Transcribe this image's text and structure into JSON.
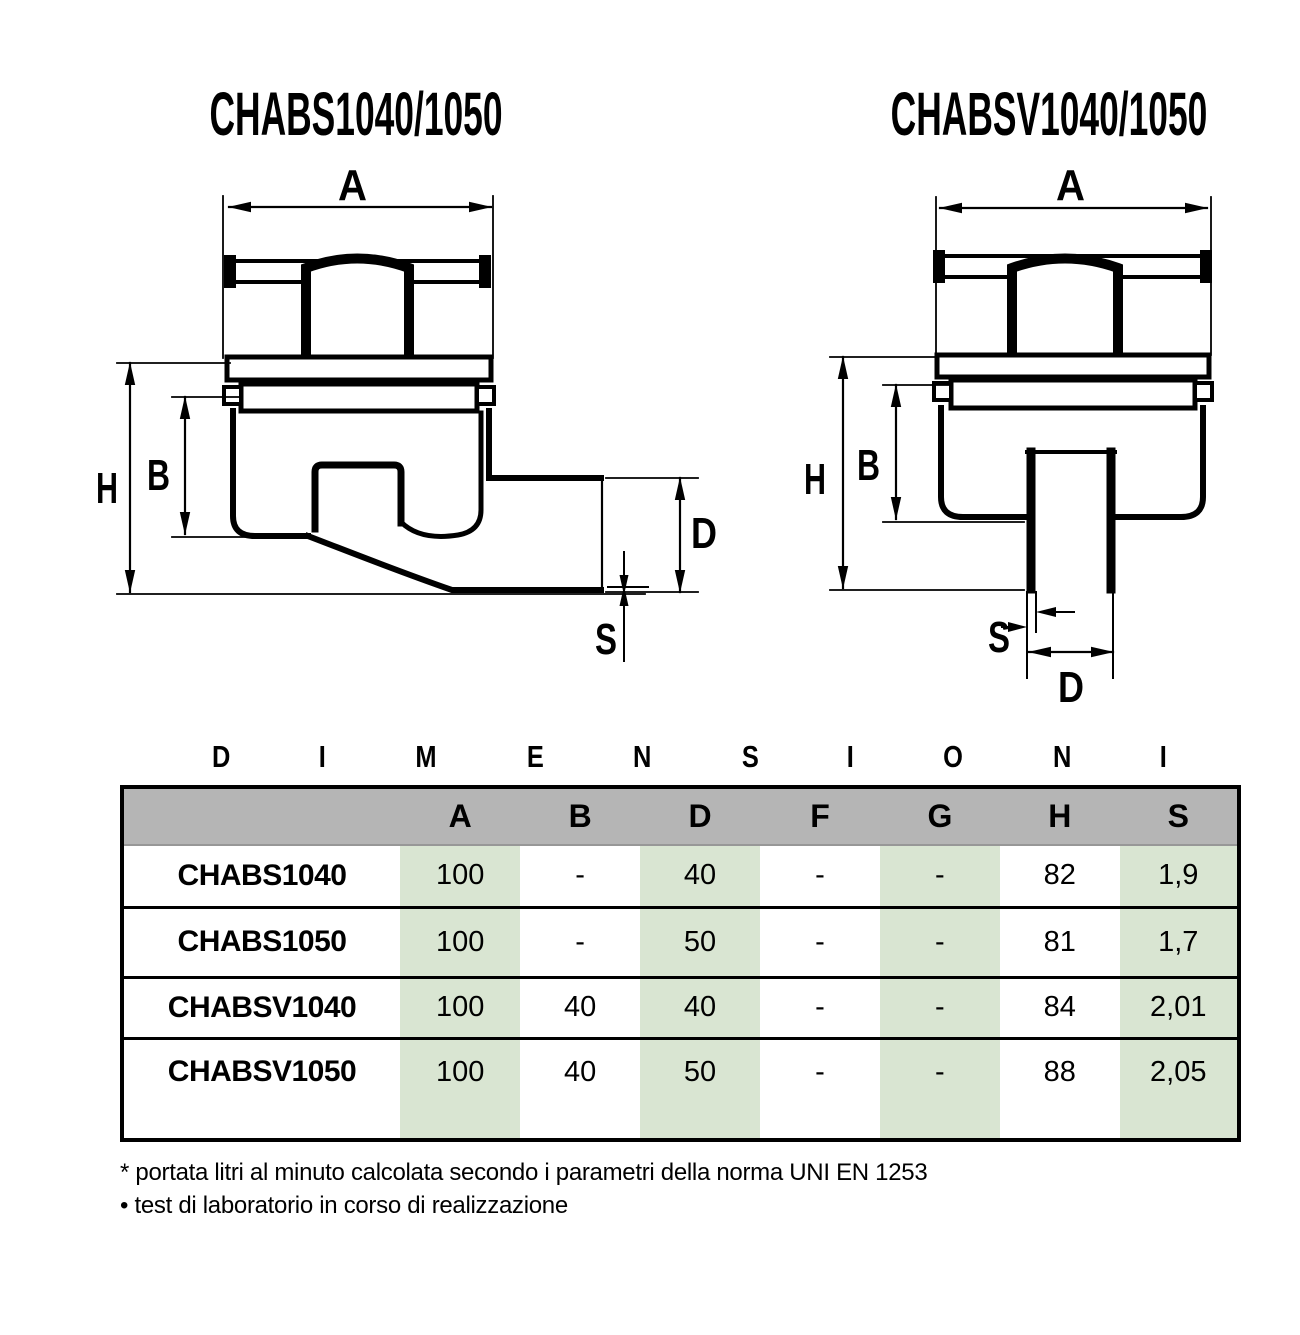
{
  "drawings": {
    "left": {
      "title": "CHABS1040/1050",
      "dim_labels": {
        "a": "A",
        "h": "H",
        "b": "B",
        "d": "D",
        "s": "S"
      }
    },
    "right": {
      "title": "CHABSV1040/1050",
      "dim_labels": {
        "a": "A",
        "h": "H",
        "b": "B",
        "d": "D",
        "s": "S"
      }
    }
  },
  "section_title": {
    "letters": [
      "D",
      "I",
      "M",
      "E",
      "N",
      "S",
      "I",
      "O",
      "N",
      "I"
    ]
  },
  "table": {
    "headers": [
      "",
      "A",
      "B",
      "D",
      "F",
      "G",
      "H",
      "S"
    ],
    "rows": [
      {
        "name": "CHABS1040",
        "values": [
          "100",
          "-",
          "40",
          "-",
          "-",
          "82",
          "1,9"
        ]
      },
      {
        "name": "CHABS1050",
        "values": [
          "100",
          "-",
          "50",
          "-",
          "-",
          "81",
          "1,7"
        ]
      },
      {
        "name": "CHABSV1040",
        "values": [
          "100",
          "40",
          "40",
          "-",
          "-",
          "84",
          "2,01"
        ]
      },
      {
        "name": "CHABSV1050",
        "values": [
          "100",
          "40",
          "50",
          "-",
          "-",
          "88",
          "2,05"
        ]
      }
    ],
    "colors": {
      "header_bg": "#b5b5b5",
      "band_green": "#d9e5d2",
      "border": "#000000"
    }
  },
  "footnotes": [
    "* portata litri al minuto calcolata secondo i parametri della norma UNI EN 1253",
    "• test di laboratorio in corso di realizzazione"
  ]
}
